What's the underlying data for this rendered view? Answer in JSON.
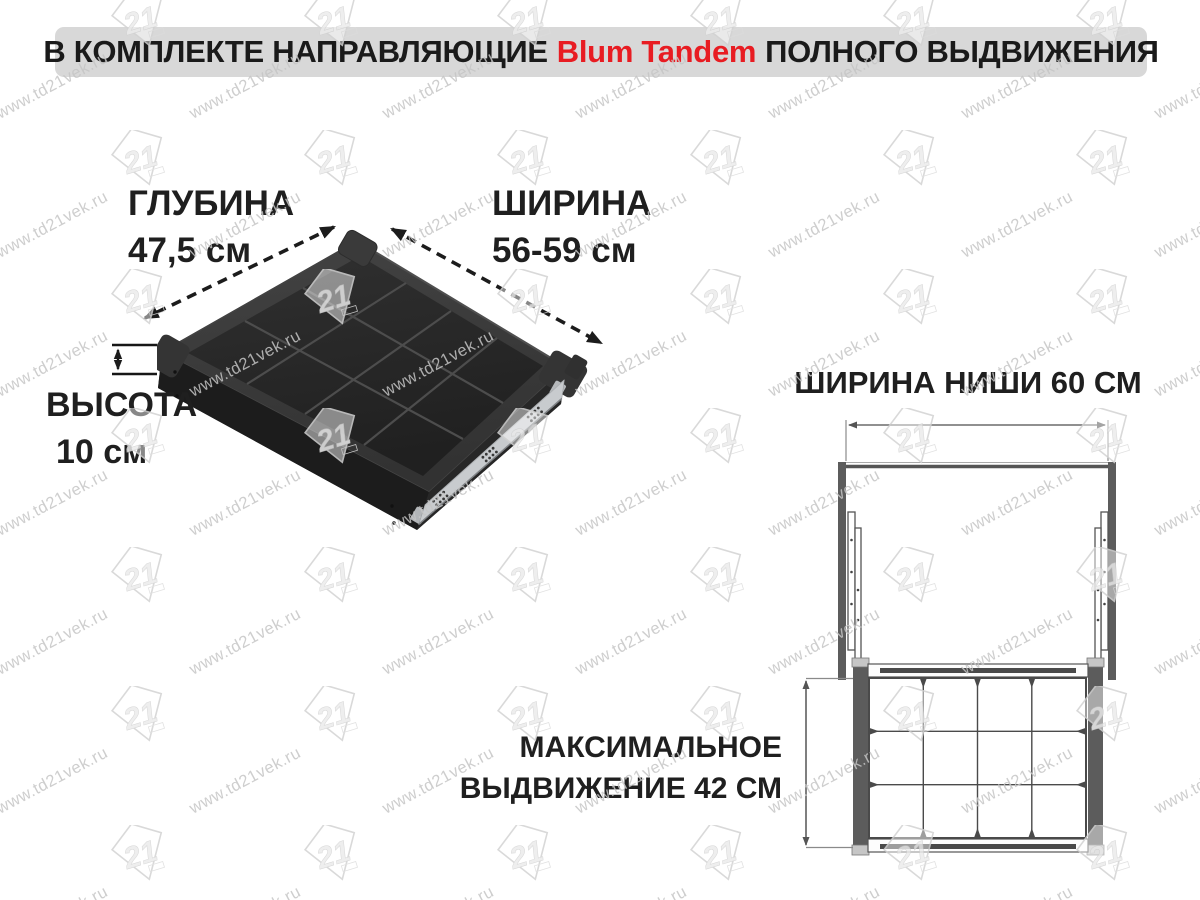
{
  "banner": {
    "prefix": "В КОМПЛЕКТЕ НАПРАВЛЯЮЩИЕ",
    "brand": "Blum Tandem",
    "suffix": "ПОЛНОГО ВЫДВИЖЕНИЯ",
    "brand_color": "#e81c22",
    "background": "#d8d8d8"
  },
  "drawer_figure": {
    "depth_label": "ГЛУБИНА",
    "depth_value": "47,5 см",
    "width_label": "ШИРИНА",
    "width_value": "56-59 см",
    "height_label": "ВЫСОТА",
    "height_value": "10 см",
    "grid_cols": 4,
    "grid_rows": 3
  },
  "niche_figure": {
    "niche_width_label": "ШИРИНА НИШИ 60 СМ",
    "extension_line1": "МАКСИМАЛЬНОЕ",
    "extension_line2": "ВЫДВИЖЕНИЕ 42 СМ",
    "grid_cols": 4,
    "grid_rows": 3
  },
  "watermark": {
    "text": "www.td21vek.ru",
    "logo": "21"
  },
  "colors": {
    "drawer_body": "#2e2e2e",
    "drawer_face_dark": "#1c1c1c",
    "rail_silver": "#c8cbce",
    "diagram_lines": "#4a4a4a",
    "panel_gray": "#5c5c5c",
    "accent_red": "#e81c22",
    "banner_bg": "#d8d8d8",
    "watermark_gray": "#c5c5c5"
  }
}
